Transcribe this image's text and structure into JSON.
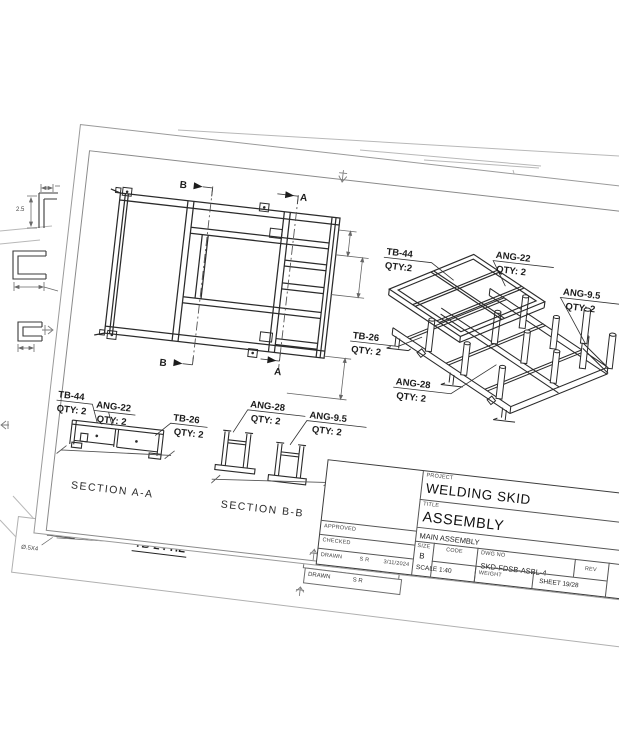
{
  "colors": {
    "part_line": "#2b2b2b",
    "sheet_edge": "#b8b8b8",
    "frame_border": "#8a8a8a",
    "dim_line": "#555555"
  },
  "sheet": {
    "plan": {
      "marker_a": "A",
      "marker_b": "B"
    },
    "iso_labels": [
      {
        "name": "TB-44",
        "qty": "QTY:2"
      },
      {
        "name": "ANG-22",
        "qty": "QTY: 2"
      },
      {
        "name": "ANG-9.5",
        "qty": "QTY: 2"
      },
      {
        "name": "TB-26",
        "qty": "QTY: 2"
      },
      {
        "name": "ANG-28",
        "qty": "QTY: 2"
      }
    ],
    "section_a": {
      "title": "SECTION A-A",
      "labels": [
        {
          "name": "TB-44",
          "qty": "QTY: 2"
        },
        {
          "name": "ANG-22",
          "qty": "QTY: 2"
        },
        {
          "name": "TB-26",
          "qty": "QTY: 2"
        }
      ]
    },
    "section_b": {
      "title": "SECTION B-B",
      "labels": [
        {
          "name": "ANG-28",
          "qty": "QTY: 2"
        },
        {
          "name": "ANG-9.5",
          "qty": "QTY: 2"
        }
      ]
    },
    "title_block": {
      "project_label": "PROJECT",
      "project": "WELDING SKID",
      "title_label": "TITLE",
      "title": "ASSEMBLY",
      "subtitle": "MAIN ASSEMBLY",
      "size_label": "SIZE",
      "size": "B",
      "code_label": "CODE",
      "dwg_label": "DWG NO",
      "dwg_no": "SKD-FDSB-ASBL-4",
      "scale": "SCALE  1:40",
      "weight_label": "WEIGHT",
      "sheet_label": "SHEET  19/28",
      "rev_label": "REV",
      "approved_label": "APPROVED",
      "checked_label": "CHECKED",
      "drawn_label": "DRAWN",
      "drawn_by": "S R",
      "date": "3/11/2024"
    }
  },
  "background": {
    "tb24_label": "TB-24-HL",
    "dia_label": "Ø.5X4",
    "dim_label": "2.5",
    "behind_checked": "CHECKED",
    "behind_drawn": "DRAWN",
    "behind_drawn_by": "S R"
  }
}
